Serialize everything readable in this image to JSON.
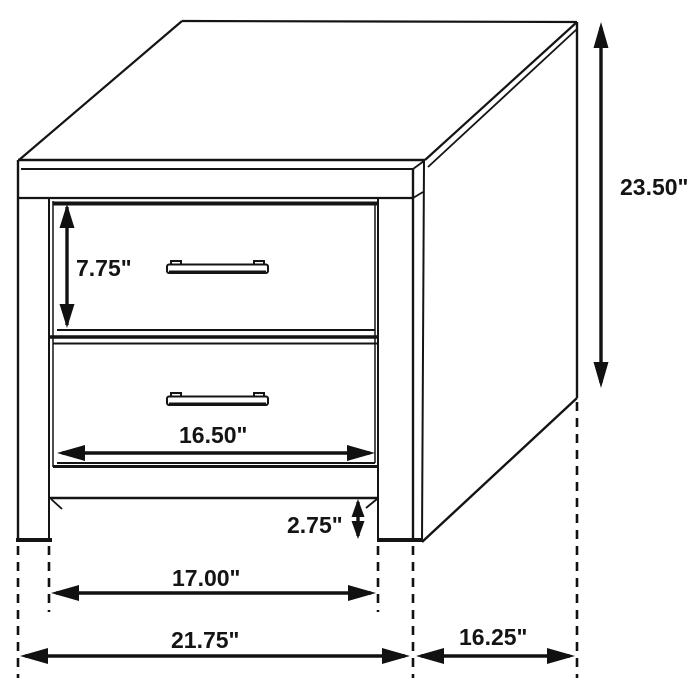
{
  "diagram": {
    "type": "furniture-dimension-drawing",
    "line_color": "#141414",
    "background_color": "#ffffff"
  },
  "dimensions": {
    "overall_height": {
      "label": "23.50\""
    },
    "drawer_height": {
      "label": "7.75\""
    },
    "drawer_width": {
      "label": "16.50\""
    },
    "leg_height": {
      "label": "2.75\""
    },
    "leg_span": {
      "label": "17.00\""
    },
    "overall_width": {
      "label": "21.75\""
    },
    "overall_depth": {
      "label": "16.25\""
    }
  }
}
